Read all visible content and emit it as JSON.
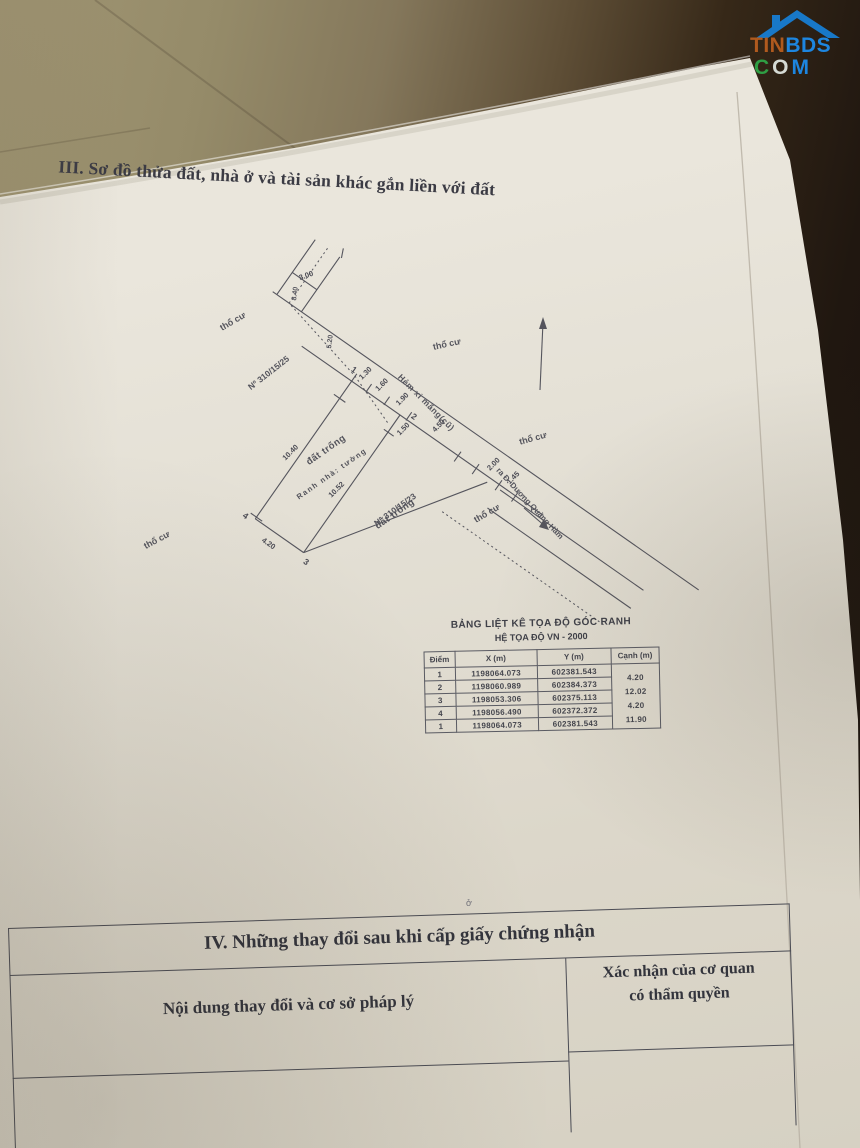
{
  "logo": {
    "tin": "TIN",
    "bds": "BDS",
    "c": "C",
    "o": "O",
    "m": "M",
    "colors": {
      "roof": "#1878c8",
      "tin": "#b05a1e",
      "bds": "#1d86e0",
      "c_green": "#2f9e44",
      "o_gray": "#d5dad4",
      "m_blue": "#1d86e0"
    }
  },
  "section3": {
    "title": "III. Sơ đồ thửa đất, nhà ở và tài sản khác gắn liền với đất"
  },
  "diagram": {
    "labels": {
      "alley": "Hẻm xi măng(cũ)",
      "road_out": "ra Đ. Dương Quảng Hàm",
      "residential": "thổ cư",
      "parcel_no_25": "Nº 310/15/25",
      "parcel_no_23": "Nº 310/15/23",
      "empty_land": "đất trống",
      "house_boundary": "Ranh nhà: tường"
    },
    "dims": {
      "path_width": "3.00",
      "path_len": "8.40",
      "path_seg": "5.20",
      "front1": "1.30",
      "front2": "1.60",
      "front3": "1.90",
      "alley_front": "4.50",
      "inset": "1.50",
      "nw_edge": "10.40",
      "wall": "10.52",
      "back_edge": "4.20",
      "seg200": "2.00",
      "seg145": "1.45"
    },
    "points": {
      "p1": "1",
      "p2": "2",
      "p3": "3",
      "p4": "4"
    }
  },
  "coord_table": {
    "title": "BẢNG LIỆT KÊ TỌA ĐỘ GÓC RANH",
    "subtitle": "HỆ TỌA ĐỘ VN - 2000",
    "headers": [
      "Điểm",
      "X (m)",
      "Y (m)",
      "Cạnh (m)"
    ],
    "rows": [
      [
        "1",
        "1198064.073",
        "602381.543"
      ],
      [
        "2",
        "1198060.989",
        "602384.373"
      ],
      [
        "3",
        "1198053.306",
        "602375.113"
      ],
      [
        "4",
        "1198056.490",
        "602372.372"
      ],
      [
        "1",
        "1198064.073",
        "602381.543"
      ]
    ],
    "edges": [
      "4.20",
      "12.02",
      "4.20",
      "11.90"
    ]
  },
  "section4": {
    "title": "IV. Những thay đổi sau khi cấp giấy chứng nhận",
    "left_header": "Nội dung thay đổi và cơ sở pháp lý",
    "right_header_line1": "Xác nhận của cơ quan",
    "right_header_line2": "có thẩm quyền"
  },
  "stray_mark": "ở"
}
